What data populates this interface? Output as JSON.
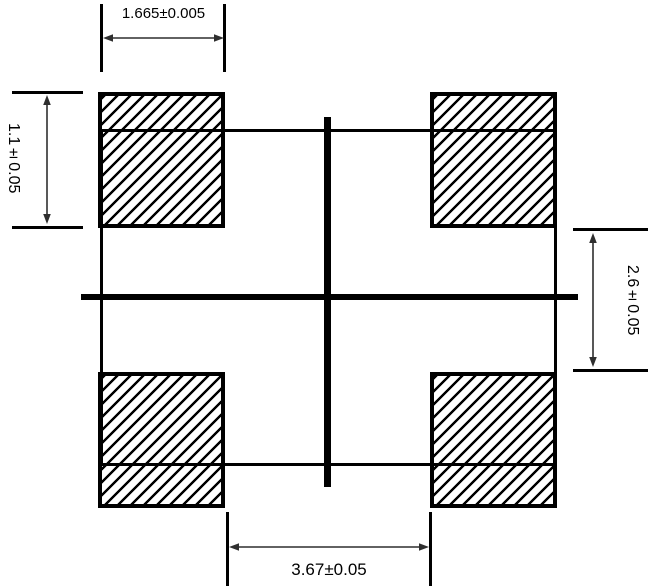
{
  "drawing": {
    "type": "engineering-dimension-diagram",
    "colors": {
      "line": "#000000",
      "arrow": "#2f2f2f",
      "background": "#ffffff"
    },
    "dimensions": {
      "top": {
        "label": "1.665±0.005"
      },
      "left": {
        "label": "1.1±0.05"
      },
      "right": {
        "label": "2.6±0.05"
      },
      "bottom": {
        "label": "3.67±0.05"
      }
    }
  }
}
